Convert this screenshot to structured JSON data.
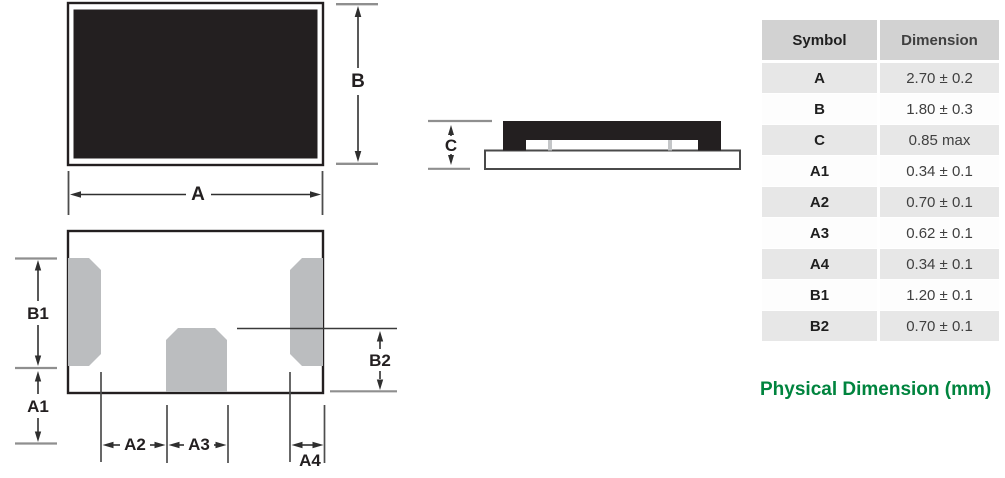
{
  "colors": {
    "ink_black": "#231f20",
    "pad_gray": "#bbbdbf",
    "tick_gray": "#c4c6c8",
    "ext_line_gray": "#8f8f8f",
    "dim_line": "#2f2f2f",
    "table_header_bg": "#d2d2d2",
    "table_row_bg": "#e7e7e7",
    "accent_green": "#00843e"
  },
  "diagram": {
    "labels": {
      "A": "A",
      "B": "B",
      "C": "C",
      "A1": "A1",
      "A2": "A2",
      "A3": "A3",
      "A4": "A4",
      "B1": "B1",
      "B2": "B2"
    }
  },
  "table": {
    "headers": [
      "Symbol",
      "Dimension"
    ],
    "rows": [
      {
        "symbol": "A",
        "value": "2.70 ± 0.2"
      },
      {
        "symbol": "B",
        "value": "1.80 ± 0.3"
      },
      {
        "symbol": "C",
        "value": "0.85 max"
      },
      {
        "symbol": "A1",
        "value": "0.34 ± 0.1"
      },
      {
        "symbol": "A2",
        "value": "0.70 ± 0.1"
      },
      {
        "symbol": "A3",
        "value": "0.62 ± 0.1"
      },
      {
        "symbol": "A4",
        "value": "0.34 ± 0.1"
      },
      {
        "symbol": "B1",
        "value": "1.20 ± 0.1"
      },
      {
        "symbol": "B2",
        "value": "0.70 ± 0.1"
      }
    ]
  },
  "caption": "Physical Dimension (mm)"
}
